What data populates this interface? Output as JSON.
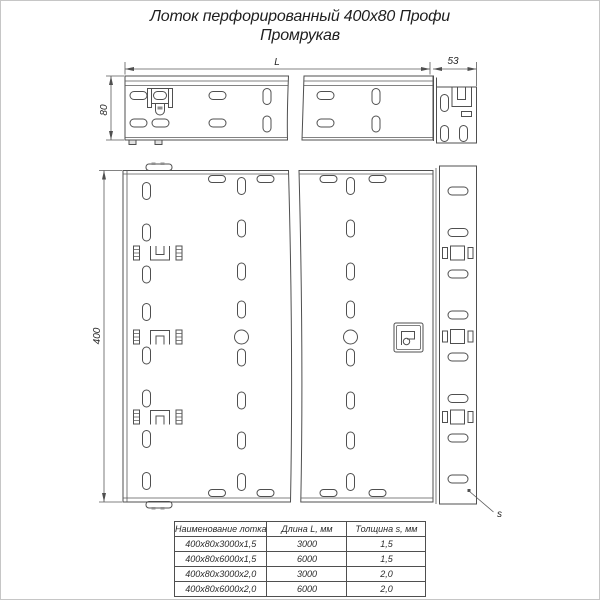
{
  "title": {
    "line1": "Лоток перфорированный 400х80 Профи",
    "line2": "Промрукав"
  },
  "dimension_labels": {
    "length": "L",
    "end_section": "53",
    "height": "80",
    "width": "400",
    "thickness": "s"
  },
  "spec_table": {
    "headers": [
      "Наименование лотка",
      "Длина L, мм",
      "Толщина s, мм"
    ],
    "rows": [
      [
        "400х80х3000х1,5",
        "3000",
        "1,5"
      ],
      [
        "400х80х6000х1,5",
        "6000",
        "1,5"
      ],
      [
        "400х80х3000х2,0",
        "3000",
        "2,0"
      ],
      [
        "400х80х6000х2,0",
        "6000",
        "2,0"
      ]
    ]
  },
  "colors": {
    "line": "#4f4f4f",
    "text": "#262626",
    "background": "#ffffff",
    "frame": "#c6c6c6"
  }
}
